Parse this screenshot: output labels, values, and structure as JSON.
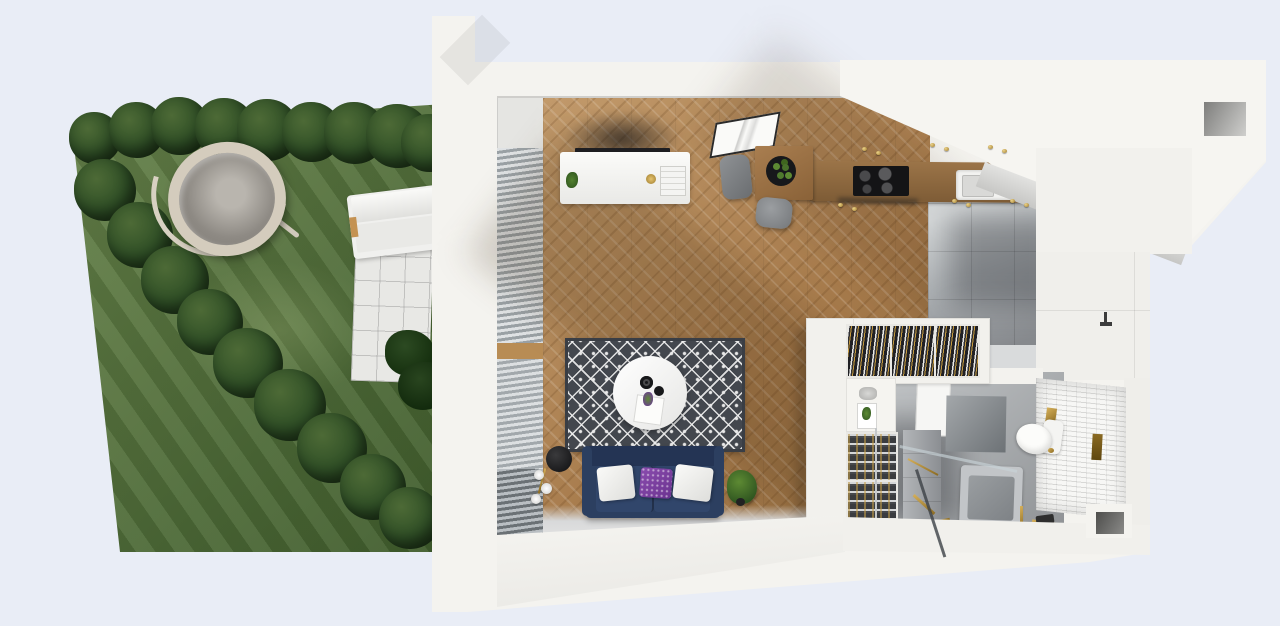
{
  "scene": {
    "type": "3d-apartment-floorplan-render",
    "view": "top-down cutaway",
    "background_color": "#e9edf6",
    "garden": {
      "grass_color": "#4f6b38",
      "tree_color": "#2e4a24",
      "tree_count": 18,
      "objects": [
        "hedge-trees",
        "striped-lawn",
        "hanging-egg-chair",
        "white-tile-patio",
        "sun-lounger",
        "dark-shrub"
      ]
    },
    "apartment": {
      "wall_color": "#f4f3ef",
      "wood_floor_color": "#b0834f",
      "tile_floor_color": "#aeb2b5",
      "rooms": [
        {
          "name": "living-room",
          "objects": [
            "window-blinds",
            "tv-sideboard",
            "flat-tv",
            "picture-frame",
            "dining-table",
            "planter-bowl",
            "gray-chair",
            "gray-stool",
            "diamond-area-rug",
            "round-coffee-table",
            "black-bowls",
            "navy-sofa",
            "white-pillows",
            "purple-pillow",
            "floor-lamp",
            "potted-plant"
          ]
        },
        {
          "name": "kitchen",
          "objects": [
            "wood-counter",
            "black-cooktop",
            "white-sink",
            "faucet",
            "upper-cabinet-soffit",
            "gold-cabinet-handles",
            "gray-tile-floor",
            "tall-white-unit"
          ]
        },
        {
          "name": "wardrobe",
          "objects": [
            "hanging-clothes-rack-1",
            "hanging-clothes-rack-2",
            "hanging-clothes-rack-3",
            "decor-shelf",
            "shoe-rack-1",
            "shoe-rack-2",
            "metal-rail"
          ]
        },
        {
          "name": "bathroom",
          "objects": [
            "door-leaf",
            "concrete-panel",
            "subway-tile-wall",
            "toilet",
            "gold-flush-button",
            "gold-soap-box",
            "bronze-towel-bar",
            "gray-vanity",
            "bathtub-shower",
            "glass-screen",
            "gold-plumbing",
            "black-shower-head",
            "wall-faucet",
            "wall-niche"
          ]
        }
      ],
      "openings": [
        "top-right-window-notch",
        "bottom-right-wall-niche"
      ]
    },
    "palette": {
      "building_white": "#f4f3ef",
      "wall_band": "#f1f0ec",
      "wood_floor": "#b5885a",
      "wood_counter": "#8a6845",
      "gray_tile": "#aeb2b5",
      "rug_dark": "#43474e",
      "rug_light": "#e8e8e8",
      "sofa_navy": "#2c3f60",
      "pillow_purple": "#7b3f9e",
      "brass_gold": "#c9a24a",
      "grass_green": "#4f6b38",
      "tree_green": "#2e4a24",
      "egg_chair_rattan": "#d4ccbd",
      "concrete_gray": "#8e9194"
    }
  }
}
